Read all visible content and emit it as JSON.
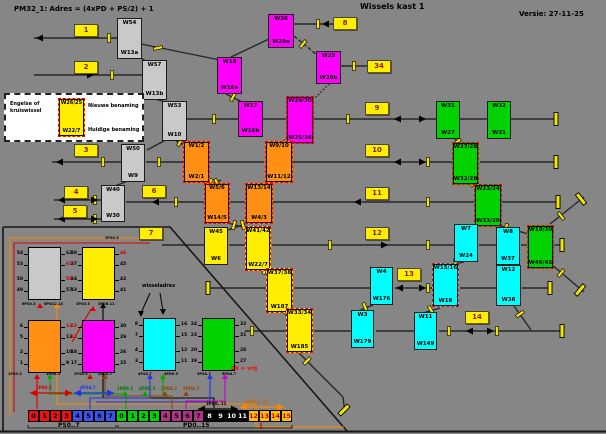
{
  "header": {
    "formula": "PM32_1: Adres = (4xPD + PS/2) + 1",
    "title": "Wissels kast 1",
    "version": "Versie: 27-11-25"
  },
  "legend": {
    "line1": "Engelse of",
    "line2": "kruiswissel",
    "box_top": "W26/25",
    "box_bottom": "W22/7",
    "new_label": "Nieuwe benaming",
    "old_label": "Huidige benaming"
  },
  "colors": {
    "gray": "#c9c9c9",
    "magenta": "#ff00ff",
    "orange": "#ff9013",
    "yellow": "#ffee00",
    "green": "#00d300",
    "cyan": "#00ffff",
    "crossing_border": "#ff0000",
    "track": "#262626",
    "insulator": "#f2e400"
  },
  "switches": [
    {
      "id": "W54",
      "top": "W54",
      "bottom": "W13a",
      "color": "gray",
      "crossing": false,
      "x": 117,
      "y": 18,
      "w": 25,
      "h": 41
    },
    {
      "id": "W57",
      "top": "W57",
      "bottom": "W13b",
      "color": "gray",
      "crossing": false,
      "x": 142,
      "y": 60,
      "w": 25,
      "h": 40
    },
    {
      "id": "W53",
      "top": "W53",
      "bottom": "W10",
      "color": "gray",
      "crossing": false,
      "x": 162,
      "y": 101,
      "w": 25,
      "h": 40
    },
    {
      "id": "W50",
      "top": "W50",
      "bottom": "W9",
      "color": "gray",
      "crossing": false,
      "x": 121,
      "y": 144,
      "w": 24,
      "h": 38
    },
    {
      "id": "W40",
      "top": "W40",
      "bottom": "W30",
      "color": "gray",
      "crossing": false,
      "x": 101,
      "y": 185,
      "w": 24,
      "h": 37
    },
    {
      "id": "W26",
      "top": "W26",
      "bottom": "W29a",
      "color": "magenta",
      "crossing": false,
      "x": 268,
      "y": 14,
      "w": 26,
      "h": 34
    },
    {
      "id": "W25",
      "top": "W25",
      "bottom": "W29b",
      "color": "magenta",
      "crossing": false,
      "x": 316,
      "y": 51,
      "w": 25,
      "h": 33
    },
    {
      "id": "W18",
      "top": "W18",
      "bottom": "W16a",
      "color": "magenta",
      "crossing": false,
      "x": 217,
      "y": 57,
      "w": 25,
      "h": 37
    },
    {
      "id": "W17",
      "top": "W17",
      "bottom": "W16b",
      "color": "magenta",
      "crossing": false,
      "x": 238,
      "y": 101,
      "w": 25,
      "h": 36
    },
    {
      "id": "W29-30",
      "top": "W29/30",
      "bottom": "W25/26",
      "color": "magenta",
      "crossing": true,
      "x": 286,
      "y": 96,
      "w": 28,
      "h": 48
    },
    {
      "id": "W1-2",
      "top": "W1/2",
      "bottom": "W2/1",
      "color": "orange",
      "crossing": true,
      "x": 183,
      "y": 141,
      "w": 27,
      "h": 42
    },
    {
      "id": "W9-10",
      "top": "W9/10",
      "bottom": "W11/12",
      "color": "orange",
      "crossing": true,
      "x": 265,
      "y": 141,
      "w": 28,
      "h": 42
    },
    {
      "id": "W5-6",
      "top": "W5/6",
      "bottom": "W14/5",
      "color": "orange",
      "crossing": true,
      "x": 204,
      "y": 183,
      "w": 26,
      "h": 41
    },
    {
      "id": "W13-14",
      "top": "W13/14",
      "bottom": "W4/3",
      "color": "orange",
      "crossing": true,
      "x": 245,
      "y": 183,
      "w": 28,
      "h": 41
    },
    {
      "id": "W45",
      "top": "W45",
      "bottom": "W6",
      "color": "yellow",
      "crossing": false,
      "x": 204,
      "y": 227,
      "w": 24,
      "h": 38
    },
    {
      "id": "W41-42",
      "top": "W41/42",
      "bottom": "W22/7",
      "color": "yellow",
      "crossing": true,
      "x": 245,
      "y": 226,
      "w": 26,
      "h": 45
    },
    {
      "id": "W37-38",
      "top": "W37/38",
      "bottom": "W187",
      "color": "yellow",
      "crossing": true,
      "x": 266,
      "y": 268,
      "w": 27,
      "h": 45
    },
    {
      "id": "W33-34",
      "top": "W33/34",
      "bottom": "W185",
      "color": "yellow",
      "crossing": true,
      "x": 286,
      "y": 308,
      "w": 27,
      "h": 45
    },
    {
      "id": "W31",
      "top": "W31",
      "bottom": "W27",
      "color": "green",
      "crossing": false,
      "x": 436,
      "y": 101,
      "w": 24,
      "h": 38
    },
    {
      "id": "W32",
      "top": "W32",
      "bottom": "W31",
      "color": "green",
      "crossing": false,
      "x": 487,
      "y": 101,
      "w": 24,
      "h": 38
    },
    {
      "id": "W27-28",
      "top": "W27/28",
      "bottom": "W32/28",
      "color": "green",
      "crossing": true,
      "x": 452,
      "y": 142,
      "w": 27,
      "h": 43
    },
    {
      "id": "W23-24",
      "top": "W23/24",
      "bottom": "W33/20",
      "color": "green",
      "crossing": true,
      "x": 474,
      "y": 184,
      "w": 28,
      "h": 43
    },
    {
      "id": "W19-20",
      "top": "W19/20",
      "bottom": "W46/45",
      "color": "green",
      "crossing": true,
      "x": 527,
      "y": 225,
      "w": 27,
      "h": 44
    },
    {
      "id": "W7",
      "top": "W7",
      "bottom": "W24",
      "color": "cyan",
      "crossing": false,
      "x": 454,
      "y": 224,
      "w": 24,
      "h": 38
    },
    {
      "id": "W8",
      "top": "W8",
      "bottom": "W37",
      "color": "cyan",
      "crossing": false,
      "x": 496,
      "y": 227,
      "w": 24,
      "h": 38
    },
    {
      "id": "W4",
      "top": "W4",
      "bottom": "W176",
      "color": "cyan",
      "crossing": false,
      "x": 370,
      "y": 267,
      "w": 23,
      "h": 38
    },
    {
      "id": "W15-16",
      "top": "W15/16",
      "bottom": "W19",
      "color": "cyan",
      "crossing": true,
      "x": 432,
      "y": 263,
      "w": 27,
      "h": 44
    },
    {
      "id": "W12",
      "top": "W12",
      "bottom": "W38",
      "color": "cyan",
      "crossing": false,
      "x": 496,
      "y": 265,
      "w": 25,
      "h": 41
    },
    {
      "id": "W3",
      "top": "W3",
      "bottom": "W179",
      "color": "cyan",
      "crossing": false,
      "x": 351,
      "y": 310,
      "w": 23,
      "h": 38
    },
    {
      "id": "W11",
      "top": "W11",
      "bottom": "W149",
      "color": "cyan",
      "crossing": false,
      "x": 414,
      "y": 312,
      "w": 23,
      "h": 38
    }
  ],
  "buttons": [
    {
      "label": "1",
      "x": 74,
      "y": 24
    },
    {
      "label": "2",
      "x": 74,
      "y": 61
    },
    {
      "label": "3",
      "x": 74,
      "y": 144
    },
    {
      "label": "4",
      "x": 64,
      "y": 186
    },
    {
      "label": "5",
      "x": 63,
      "y": 205
    },
    {
      "label": "6",
      "x": 142,
      "y": 185
    },
    {
      "label": "7",
      "x": 139,
      "y": 227
    },
    {
      "label": "8",
      "x": 333,
      "y": 17
    },
    {
      "label": "34",
      "x": 367,
      "y": 60
    },
    {
      "label": "9",
      "x": 365,
      "y": 102
    },
    {
      "label": "10",
      "x": 365,
      "y": 144
    },
    {
      "label": "11",
      "x": 365,
      "y": 187
    },
    {
      "label": "12",
      "x": 365,
      "y": 227
    },
    {
      "label": "13",
      "x": 397,
      "y": 268
    },
    {
      "label": "14",
      "x": 465,
      "y": 311
    }
  ],
  "modecs": [
    {
      "name": "MODEC6",
      "ps": "PS:0...3",
      "pd": "PD:12...15",
      "color": "#c9c9c9",
      "x": 28,
      "y": 247,
      "left": [
        "54",
        "53",
        "50",
        "49"
      ],
      "right": [
        "62",
        "61",
        "58",
        "57"
      ],
      "red_left": [],
      "red_right": [
        1,
        2
      ]
    },
    {
      "name": "MODEC3",
      "ps": "PS:0...3",
      "pd": "PD:8...11",
      "color": "#ffee00",
      "x": 82,
      "y": 247,
      "left": [
        "38",
        "37",
        "34",
        "33"
      ],
      "right": [
        "46",
        "45",
        "42",
        "41"
      ],
      "red_left": [],
      "red_right": [
        0
      ]
    },
    {
      "name": "MODEC1",
      "ps": "PS:0...3",
      "pd": "PD:0...3",
      "color": "#ff9013",
      "x": 28,
      "y": 320,
      "left": [
        "6",
        "5",
        "2",
        "1"
      ],
      "right": [
        "14",
        "13",
        "10",
        "9"
      ],
      "red_left": [],
      "red_right": [
        0
      ]
    },
    {
      "name": "MODEC2",
      "ps": "PS:0...3",
      "pd": "PD:4...7",
      "color": "#ff00ff",
      "x": 82,
      "y": 320,
      "left": [
        "22",
        "21",
        "18",
        "17"
      ],
      "right": [
        "30",
        "29",
        "26",
        "25"
      ],
      "red_left": [
        0,
        1
      ],
      "red_right": []
    },
    {
      "name": "MODEC4",
      "ps": "PS:4...7",
      "pd": "PD:0...3",
      "color": "#00ffff",
      "x": 143,
      "y": 318,
      "left": [
        "8",
        "7",
        "4",
        "3"
      ],
      "right": [
        "16",
        "15",
        "12",
        "11"
      ],
      "red_left": [],
      "red_right": []
    },
    {
      "name": "MODEC5",
      "ps": "PS:4...7",
      "pd": "PD:4...7",
      "color": "#00d300",
      "x": 202,
      "y": 318,
      "left": [
        "24",
        "23",
        "20",
        "19"
      ],
      "right": [
        "32",
        "31",
        "28",
        "27"
      ],
      "red_left": [],
      "red_right": []
    }
  ],
  "bus": {
    "x": 28,
    "y": 410,
    "cell_w": 11,
    "cell_h": 12,
    "ps_label": "PS0..7",
    "pd_label": "PD0..15",
    "groups": [
      {
        "name": "ps-low",
        "bg": "#ee1111",
        "fg": "#000000",
        "cells": [
          "0",
          "1",
          "2",
          "3"
        ]
      },
      {
        "name": "ps-high",
        "bg": "#3a52f0",
        "fg": "#000000",
        "cells": [
          "4",
          "5",
          "6",
          "7"
        ]
      },
      {
        "name": "pd-0-3",
        "bg": "#00d300",
        "fg": "#000000",
        "cells": [
          "0",
          "1",
          "2",
          "3"
        ]
      },
      {
        "name": "pd-4-7",
        "bg": "#b03387",
        "fg": "#000000",
        "cells": [
          "4",
          "5",
          "6",
          "7"
        ]
      },
      {
        "name": "pd-8-11",
        "bg": "#000000",
        "fg": "#ffffff",
        "cells": [
          "8",
          "9",
          "10",
          "11"
        ]
      },
      {
        "name": "pd-12-15",
        "bg": "#ffc000",
        "fg": "#cc0000",
        "cells": [
          "12",
          "13",
          "14",
          "15"
        ]
      }
    ]
  },
  "labels": [
    {
      "text": "wisseladres",
      "x": 142,
      "y": 284,
      "color": "#000000",
      "size": 5
    },
    {
      "text": "29 = vrij",
      "x": 231,
      "y": 367,
      "color": "#ff0000",
      "size": 5.5
    },
    {
      "text": "1PS0.3",
      "x": 36,
      "y": 386,
      "color": "#cc0000",
      "size": 4
    },
    {
      "text": "4PS4.7",
      "x": 80,
      "y": 386,
      "color": "#2233ee",
      "size": 4
    },
    {
      "text": "1PD0.3",
      "x": 117,
      "y": 387,
      "color": "#007700",
      "size": 4
    },
    {
      "text": "4PD0.3",
      "x": 139,
      "y": 387,
      "color": "#007700",
      "size": 4
    },
    {
      "text": "2PD4.7",
      "x": 161,
      "y": 387,
      "color": "#884400",
      "size": 4
    },
    {
      "text": "5PD4.7",
      "x": 183,
      "y": 387,
      "color": "#884400",
      "size": 4
    },
    {
      "text": "3PD8..11",
      "x": 206,
      "y": 402,
      "color": "#000000",
      "size": 4
    },
    {
      "text": "6PD12..15",
      "x": 245,
      "y": 400,
      "color": "#cc6600",
      "size": 4
    },
    {
      "text": "6PS0.3",
      "x": 22,
      "y": 303,
      "color": "#000000",
      "size": 3.5
    },
    {
      "text": "6PD12.15",
      "x": 44,
      "y": 303,
      "color": "#000000",
      "size": 3.5
    },
    {
      "text": "3PS0.3",
      "x": 76,
      "y": 303,
      "color": "#000000",
      "size": 3.5
    },
    {
      "text": "3PD8.11",
      "x": 98,
      "y": 303,
      "color": "#000000",
      "size": 3.5
    },
    {
      "text": "3PS0.3",
      "x": 105,
      "y": 237,
      "color": "#000000",
      "size": 3.5
    },
    {
      "text": "1PS0.3",
      "x": 8,
      "y": 373,
      "color": "#000000",
      "size": 3.5
    },
    {
      "text": "1PD0.3",
      "x": 46,
      "y": 373,
      "color": "#000000",
      "size": 3.5
    },
    {
      "text": "2PS0.3",
      "x": 74,
      "y": 373,
      "color": "#000000",
      "size": 3.5
    },
    {
      "text": "2PD4.7",
      "x": 98,
      "y": 373,
      "color": "#000000",
      "size": 3.5
    },
    {
      "text": "4PS4.7",
      "x": 138,
      "y": 373,
      "color": "#000000",
      "size": 3.5
    },
    {
      "text": "4PD0.3",
      "x": 164,
      "y": 373,
      "color": "#000000",
      "size": 3.5
    },
    {
      "text": "5PS4.7",
      "x": 197,
      "y": 373,
      "color": "#000000",
      "size": 3.5
    },
    {
      "text": "5PD4.7",
      "x": 222,
      "y": 373,
      "color": "#000000",
      "size": 3.5
    },
    {
      "text": "PS0..7",
      "x": 58,
      "y": 423,
      "color": "#000000",
      "size": 6
    },
    {
      "text": "PD0..15",
      "x": 183,
      "y": 423,
      "color": "#000000",
      "size": 6
    }
  ]
}
